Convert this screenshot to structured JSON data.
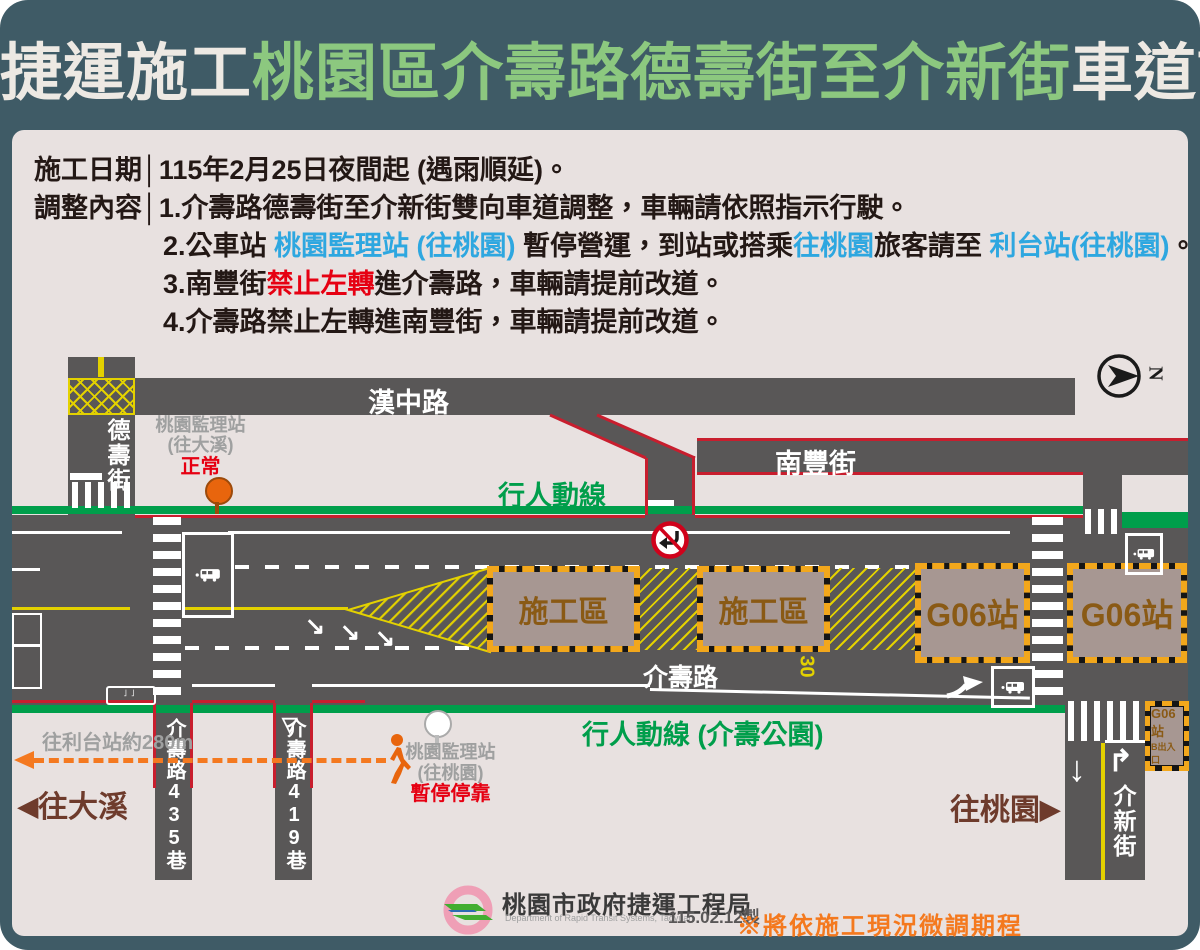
{
  "colors": {
    "frame": "#3F5B66",
    "background": "#E8E1E0",
    "road": "#595757",
    "pedestrian_green": "#009E4B",
    "curb_red": "#C81E2E",
    "marking_yellow": "#E3D100",
    "highlight_blue": "#2EA7E0",
    "alert_red": "#E60012",
    "note_orange": "#F47920",
    "direction_brown": "#6E3B2C",
    "zone_fill": "#A79792",
    "zone_text": "#8A5A15",
    "zone_border": "#F2A71C",
    "title_green": "#8CC87F"
  },
  "title": {
    "part1": "捷運施工",
    "part2": "桃園區介壽路德壽街至介新街",
    "part3": "車道調整"
  },
  "info": {
    "date_label": "施工日期",
    "divider": "│",
    "date_value": "115年2月25日夜間起 (遇雨順延)。",
    "content_label": "調整內容",
    "item1": "1.介壽路德壽街至介新街雙向車道調整，車輛請依照指示行駛。",
    "item2": {
      "pre": "2.公車站 ",
      "blue1": "桃園監理站 (往桃園)",
      "mid1": " 暫停營運，到站或搭乘",
      "blue2": "往桃園",
      "mid2": "旅客請至 ",
      "blue3": "利台站(往桃園)",
      "end": "。"
    },
    "item3": {
      "pre": "3.南豐街",
      "red": "禁止左轉",
      "post": "進介壽路，車輛請提前改道。"
    },
    "item4": "4.介壽路禁止左轉進南豐街，車輛請提前改道。"
  },
  "map": {
    "roads": {
      "hanzhong": "漢中路",
      "deshou": "德壽街",
      "nanfeng": "南豐街",
      "jieshou": "介壽路",
      "jiexin": "介新街",
      "lane435": "介壽路435巷",
      "lane419": "介壽路419巷"
    },
    "pedestrian_top": "行人動線",
    "pedestrian_bottom": "行人動線 (介壽公園)",
    "station_daxi": {
      "name": "桃園監理站",
      "direction": "(往大溪)",
      "status": "正常"
    },
    "station_taoyuan": {
      "name": "桃園監理站",
      "direction": "(往桃園)",
      "status": "暫停停靠"
    },
    "construction_label": "施工區",
    "g06_label": "G06站",
    "g06_exit": {
      "line1": "G06站",
      "line2": "B出入口"
    },
    "to_litai": "往利台站約280m",
    "to_daxi": "往大溪",
    "to_taoyuan": "往桃園",
    "speed_limit": "30",
    "compass_n": "N"
  },
  "icons": {
    "arrow_left": "◀",
    "arrow_right": "▶",
    "arrow_merge": "↘",
    "arrow_down": "↓",
    "arrow_turn_right": "↱",
    "yield_triangle": "▽"
  },
  "footer": {
    "agency": "桃園市政府捷運工程局",
    "agency_en": "Department of Rapid Transit Systems, Taoyuan",
    "made_date": "115.02.12製",
    "note": "※將依施工現況微調期程"
  }
}
